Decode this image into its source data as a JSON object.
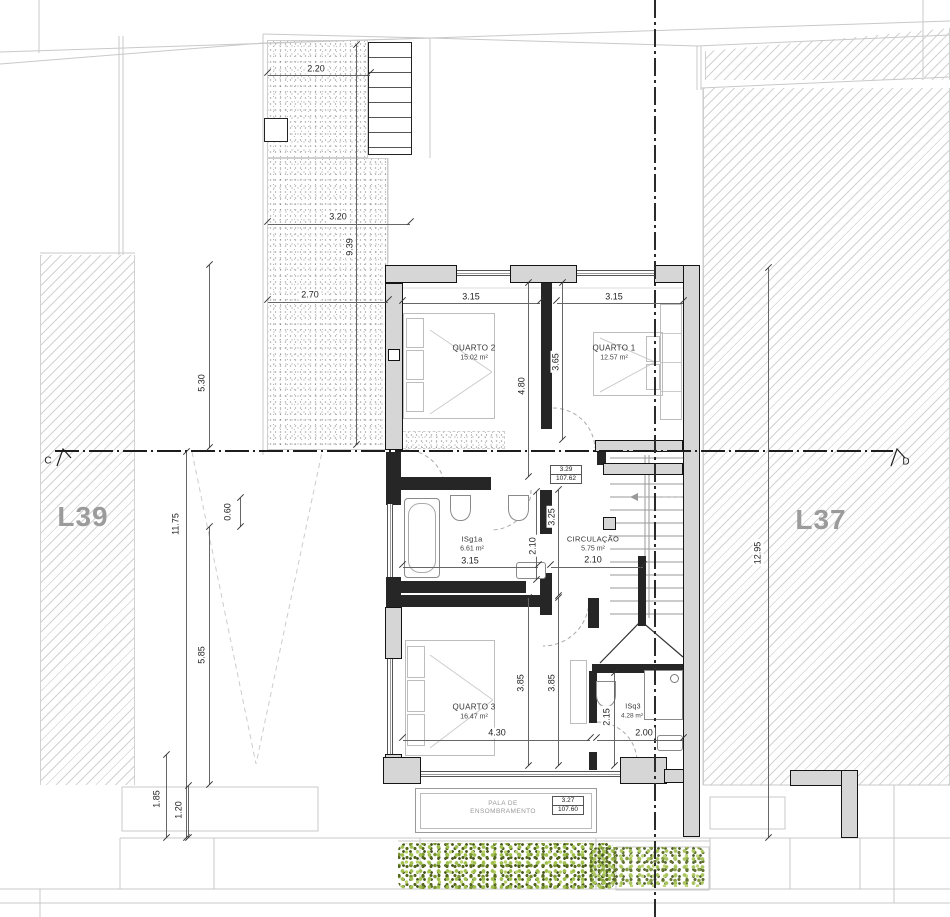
{
  "plan": {
    "lot_left": "L39",
    "lot_right": "L37",
    "section_left": "C",
    "section_right": "D"
  },
  "rooms": {
    "quarto2": {
      "name": "QUARTO 2",
      "area": "15.02 m²",
      "width": "3.15",
      "depth": "4.80"
    },
    "quarto1": {
      "name": "QUARTO 1",
      "area": "12.57 m²",
      "width": "3.15",
      "depth": "3.65"
    },
    "isg1a": {
      "name": "ISg1a",
      "area": "6.61 m²",
      "width": "3.15",
      "depth": "2.10"
    },
    "circulacao": {
      "name": "CIRCULAÇÃO",
      "area": "5.75 m²",
      "width": "2.10",
      "corridor": "3.25"
    },
    "quarto3": {
      "name": "QUARTO 3",
      "area": "16.47 m²",
      "width": "4.30",
      "depth_a": "3.85",
      "depth_b": "3.85"
    },
    "isq3": {
      "name": "ISq3",
      "area": "4.28 m²",
      "width": "2.00",
      "depth": "2.15"
    },
    "pala_line1": "PALA DE",
    "pala_line2": "ENSOMBRAMENTO"
  },
  "levels": {
    "upper": {
      "value": "3.29",
      "elevation": "107.62"
    },
    "lower": {
      "value": "3.27",
      "elevation": "107.60"
    }
  },
  "site_dims": {
    "patio_top": "2.20",
    "patio_mid": "3.20",
    "patio_len": "9.39",
    "patio_low": "2.70",
    "left_upper": "5.30",
    "left_total": "11.75",
    "left_small": "0.60",
    "left_lower": "5.85",
    "left_b1": "1.85",
    "left_b2": "1.20",
    "right_total": "12.95"
  }
}
